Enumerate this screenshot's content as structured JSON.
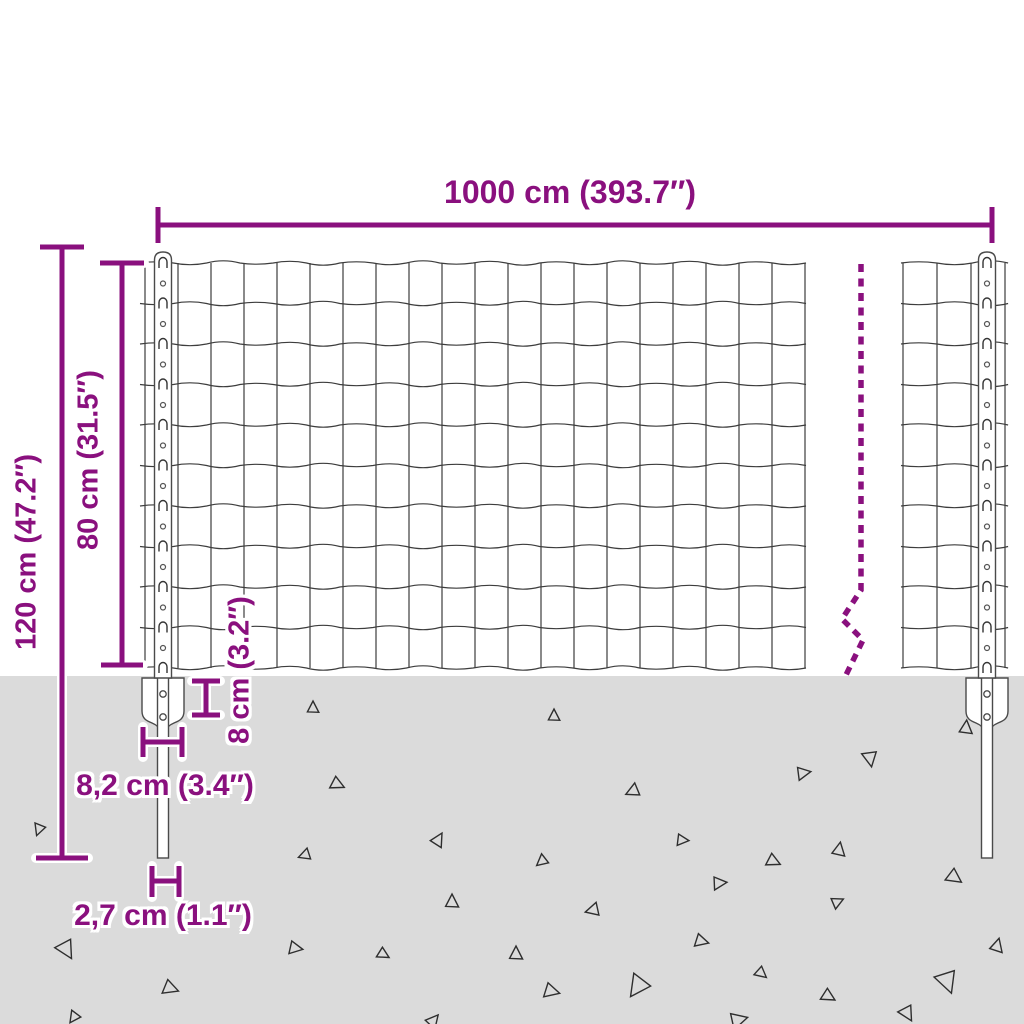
{
  "title": "Fence panel with posts - dimension diagram",
  "colors": {
    "accent": "#8a107e",
    "ground": "#dbdbdb",
    "wire": "#3d3d3d",
    "outline": "#4a4a4a",
    "triangle": "#2e2e2e",
    "white": "#ffffff"
  },
  "dimensions": {
    "width_top": "1000 cm (393.7″)",
    "height_total": "120 cm (47.2″)",
    "height_mesh": "80 cm (31.5″)",
    "plate_depth": "8 cm (3.2″)",
    "plate_width": "8,2 cm (3.4″)",
    "spike_width": "2,7 cm (1.1″)"
  },
  "diagram": {
    "ground_y": 676,
    "mesh": {
      "rows": 10,
      "top_y": 263,
      "bottom_y": 668,
      "row_px": 40.5,
      "left": {
        "x0": 140,
        "x1": 806,
        "v_start": 145,
        "v_step": 33,
        "v_count": 21
      },
      "right": {
        "x0": 901,
        "x1": 1008,
        "v_start": 903,
        "v_step": 34,
        "v_count": 4
      },
      "wave_amp": 4
    },
    "posts": [
      {
        "cx": 163
      },
      {
        "cx": 987
      }
    ],
    "post_geom": {
      "top_y": 252,
      "half_w": 8.5,
      "spike_half_w": 5.5,
      "spike_bottom": 858,
      "plate_top": 678,
      "plate_half_w": 21,
      "plate_tip_y": 733,
      "hole1_y": 694,
      "hole2_y": 717
    },
    "break_line": {
      "points": [
        [
          861,
          264
        ],
        [
          861,
          590
        ],
        [
          842,
          619
        ],
        [
          863,
          640
        ],
        [
          845,
          677
        ]
      ],
      "dash": "8 6.5",
      "width": 5.5
    },
    "dimension_lines": [
      [
        [
          158,
          207
        ],
        [
          158,
          243
        ]
      ],
      [
        [
          158,
          225
        ],
        [
          992,
          225
        ]
      ],
      [
        [
          992,
          207
        ],
        [
          992,
          243
        ]
      ],
      [
        [
          40,
          247
        ],
        [
          84,
          247
        ]
      ],
      [
        [
          62,
          247
        ],
        [
          62,
          858
        ]
      ],
      [
        [
          36,
          858
        ],
        [
          88,
          858
        ]
      ],
      [
        [
          100,
          263
        ],
        [
          144,
          263
        ]
      ],
      [
        [
          122,
          263
        ],
        [
          122,
          665
        ]
      ],
      [
        [
          101,
          665
        ],
        [
          143,
          665
        ]
      ],
      [
        [
          192,
          681
        ],
        [
          220,
          681
        ]
      ],
      [
        [
          206,
          681
        ],
        [
          206,
          715
        ]
      ],
      [
        [
          192,
          715
        ],
        [
          220,
          715
        ]
      ],
      [
        [
          143,
          727
        ],
        [
          143,
          757
        ]
      ],
      [
        [
          143,
          742
        ],
        [
          182,
          742
        ]
      ],
      [
        [
          182,
          727
        ],
        [
          182,
          757
        ]
      ],
      [
        [
          152,
          866
        ],
        [
          152,
          897
        ]
      ],
      [
        [
          152,
          881
        ],
        [
          179,
          881
        ]
      ],
      [
        [
          179,
          866
        ],
        [
          179,
          897
        ]
      ]
    ],
    "triangles": [
      [
        313,
        708,
        7,
        0
      ],
      [
        337,
        784,
        8,
        115
      ],
      [
        39,
        829,
        7,
        200
      ],
      [
        438,
        840,
        8,
        30
      ],
      [
        305,
        855,
        7,
        250
      ],
      [
        452,
        902,
        8,
        0
      ],
      [
        66,
        949,
        11,
        150
      ],
      [
        295,
        948,
        8,
        100
      ],
      [
        383,
        954,
        7,
        120
      ],
      [
        170,
        988,
        9,
        110
      ],
      [
        74,
        1017,
        7,
        215
      ],
      [
        433,
        1021,
        8,
        40
      ],
      [
        554,
        716,
        7,
        0
      ],
      [
        966,
        728,
        8,
        5
      ],
      [
        870,
        758,
        9,
        170
      ],
      [
        803,
        773,
        8,
        80
      ],
      [
        633,
        791,
        8,
        245
      ],
      [
        682,
        840,
        7,
        95
      ],
      [
        542,
        861,
        7,
        230
      ],
      [
        773,
        861,
        8,
        115
      ],
      [
        839,
        850,
        8,
        10
      ],
      [
        719,
        883,
        8,
        85
      ],
      [
        954,
        877,
        9,
        125
      ],
      [
        837,
        902,
        7,
        65
      ],
      [
        593,
        910,
        8,
        255
      ],
      [
        701,
        941,
        8,
        105
      ],
      [
        516,
        954,
        8,
        0
      ],
      [
        761,
        973,
        7,
        130
      ],
      [
        997,
        946,
        8,
        15
      ],
      [
        947,
        981,
        13,
        160
      ],
      [
        551,
        991,
        9,
        105
      ],
      [
        638,
        986,
        13,
        215
      ],
      [
        828,
        996,
        8,
        120
      ],
      [
        907,
        1013,
        9,
        150
      ],
      [
        738,
        1020,
        10,
        75
      ]
    ]
  }
}
